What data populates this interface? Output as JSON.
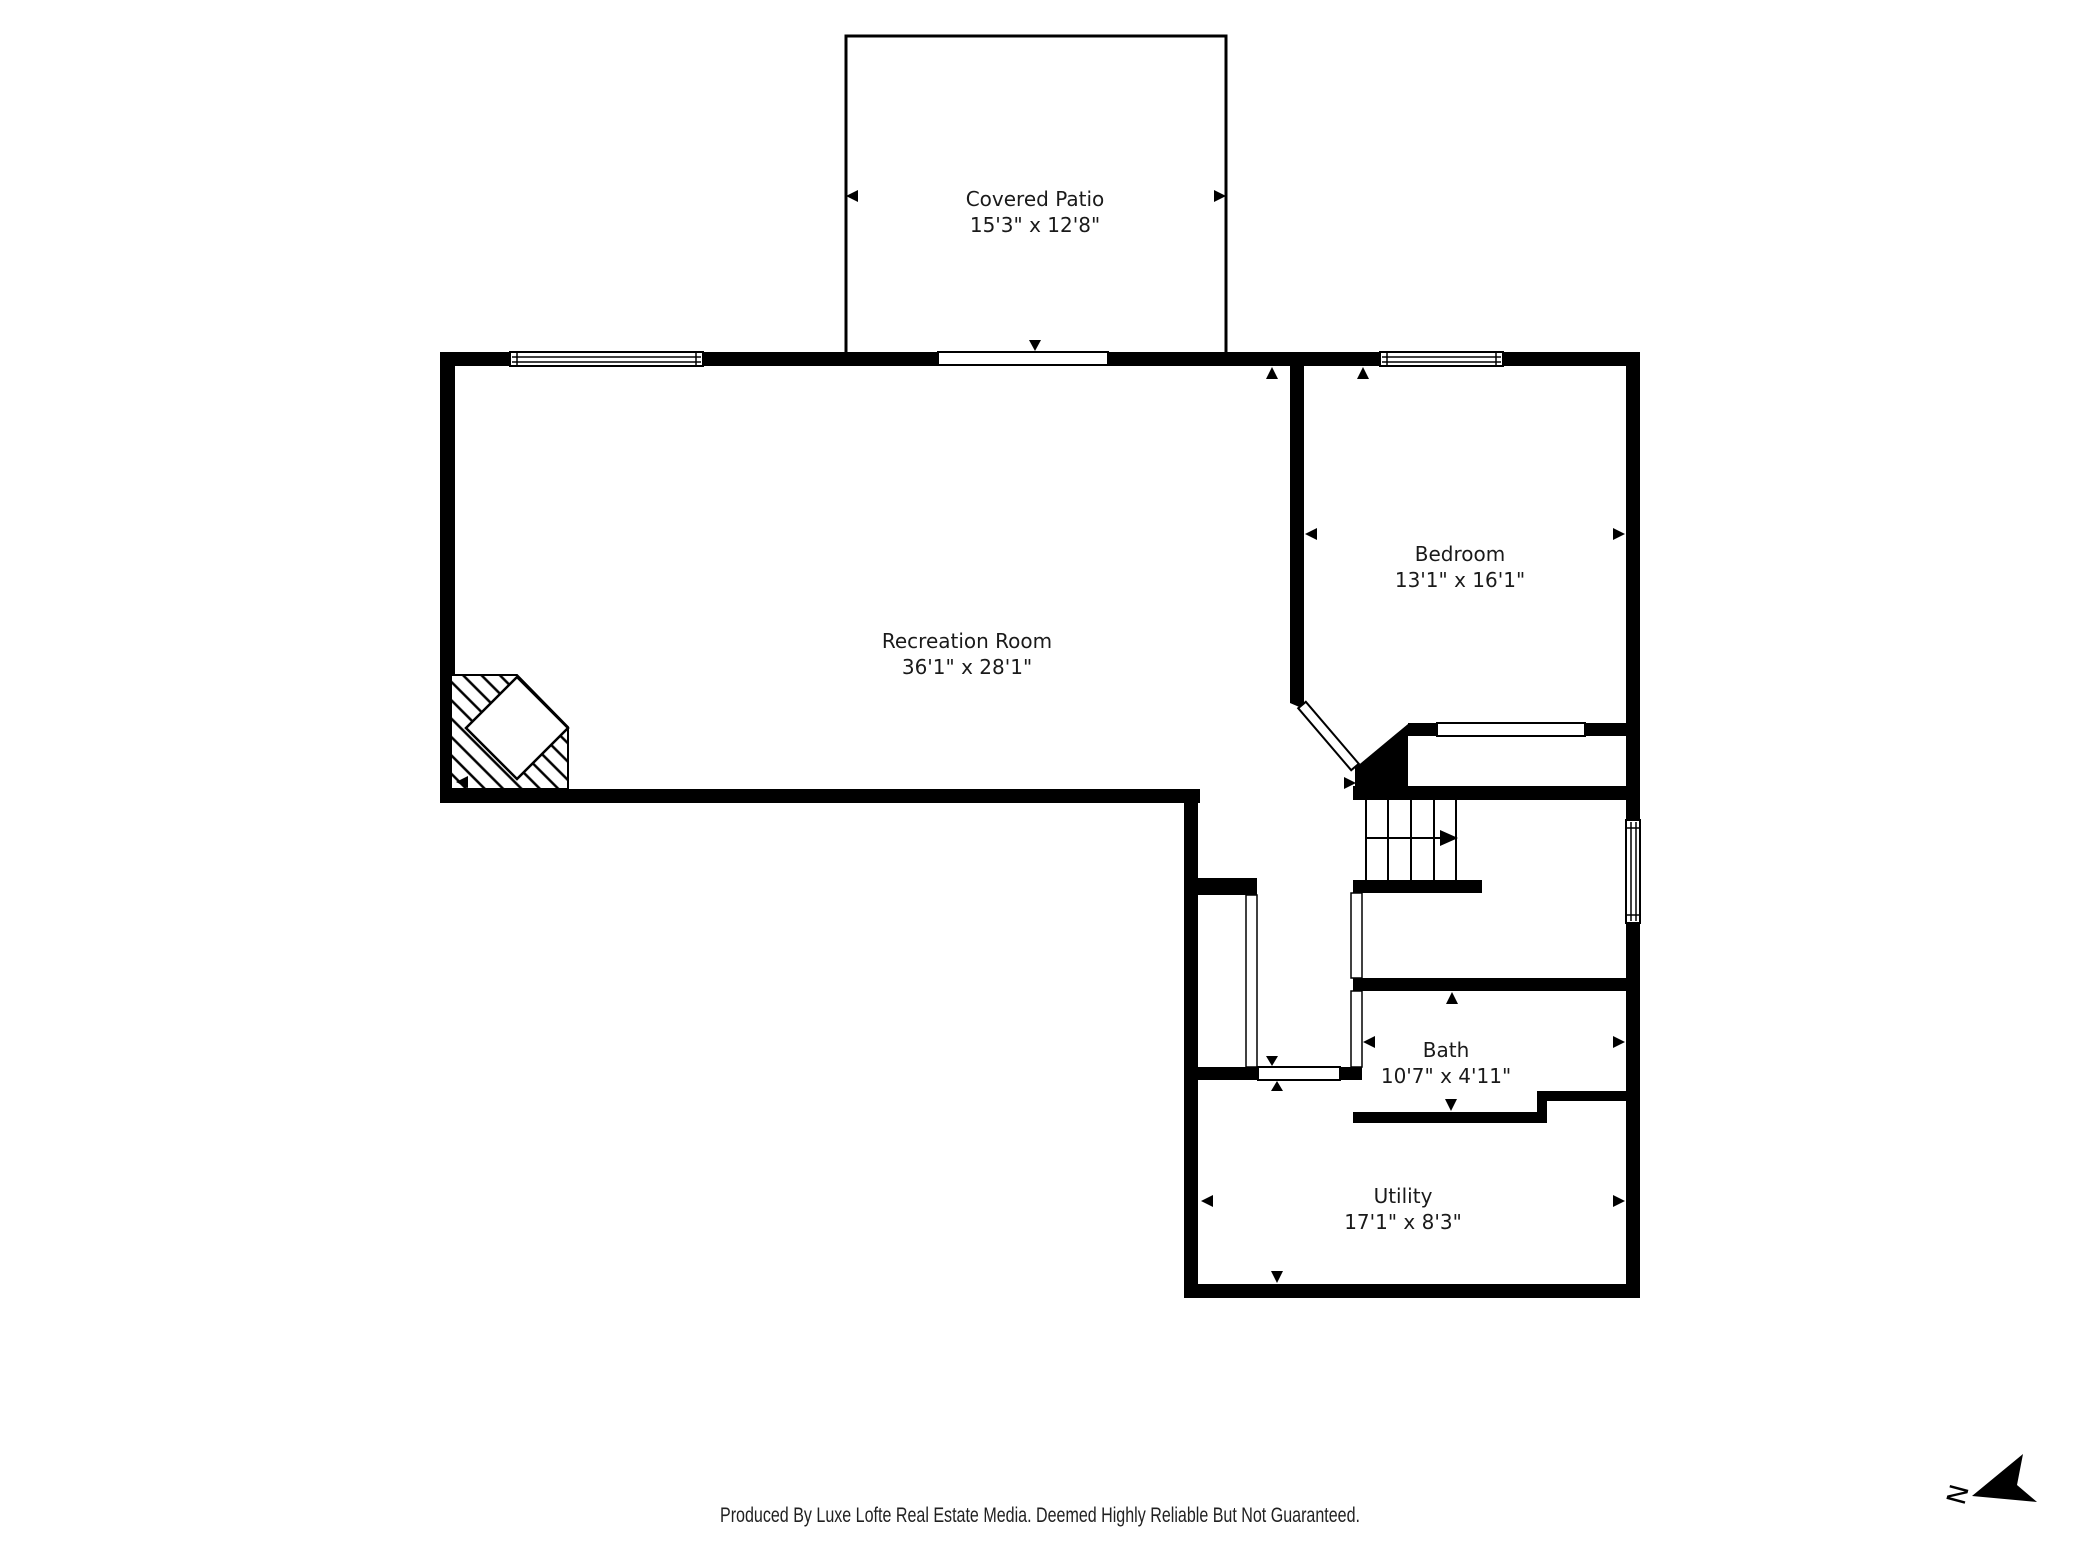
{
  "rooms": [
    {
      "id": "covered-patio",
      "name": "Covered Patio",
      "dims": "15'3\" x 12'8\""
    },
    {
      "id": "recreation-room",
      "name": "Recreation Room",
      "dims": "36'1\" x 28'1\""
    },
    {
      "id": "bedroom",
      "name": "Bedroom",
      "dims": "13'1\" x 16'1\""
    },
    {
      "id": "bath",
      "name": "Bath",
      "dims": "10'7\" x 4'11\""
    },
    {
      "id": "utility",
      "name": "Utility",
      "dims": "17'1\" x 8'3\""
    }
  ],
  "footer": {
    "text": "Produced By Luxe Lofte Real Estate Media. Deemed Highly Reliable But Not Guaranteed."
  },
  "compass": {
    "label": "N"
  },
  "colors": {
    "wall": "#000000",
    "background": "#ffffff",
    "label_text": "#1a1a1a",
    "footer_text": "#222222"
  }
}
